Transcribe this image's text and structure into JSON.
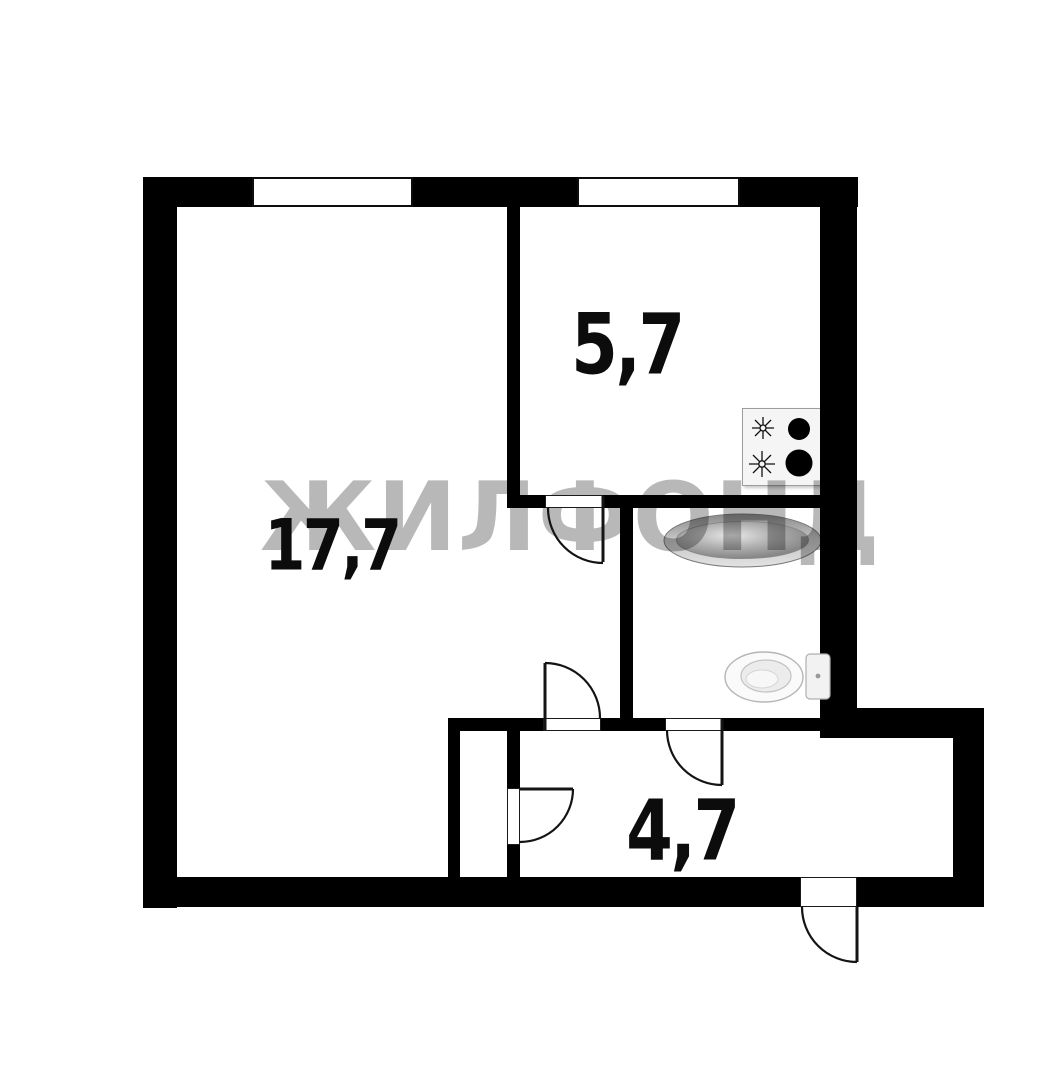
{
  "watermark": {
    "text": "ЖИЛФОНД"
  },
  "rooms": {
    "living": {
      "label": "17,7"
    },
    "kitchen": {
      "label": "5,7"
    },
    "hallway": {
      "label": "4,7"
    }
  },
  "fixtures": {
    "stove": "stove-icon",
    "bathtub": "bathtub-icon",
    "toilet": "toilet-icon"
  },
  "colors": {
    "wall": "#000000",
    "background": "#ffffff",
    "door_line": "#141414",
    "label_text": "#0c0c0c",
    "watermark": "rgba(0,0,0,0.28)",
    "fixture_outline": "#b0b0b0",
    "burner_black": "#000000"
  }
}
